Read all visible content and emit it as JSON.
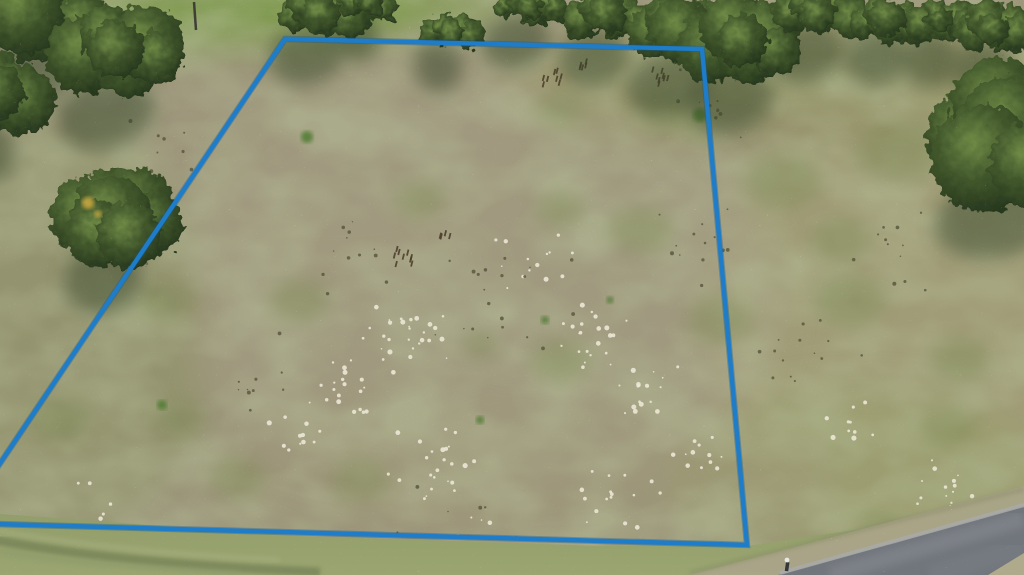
{
  "meta": {
    "title": "Aerial drone photo of a cleared vacant land parcel outlined with a blue property-boundary overlay, tree line along the top, bushes at the edges and a paved road at the lower right",
    "width": 1024,
    "height": 575
  },
  "palette": {
    "ground_base": "#9c957b",
    "boundary_blue": "#1e7cc8",
    "boundary_blue_dark": "#0e5a96",
    "tree_dark": "#20301a",
    "tree_mid": "#42582c",
    "tree_light": "#6f8a46",
    "shadow_olive": "#39462a",
    "lawn_green": "#7e9a4e",
    "verge_green": "#8f9a68",
    "road_gray": "#71757c",
    "road_edge_light": "#a8aaa8",
    "shoulder_tan": "#aaa488",
    "sand_white": "#ece7d6",
    "speck_dark": "#55543c",
    "weed_brown": "#4a3b28",
    "autumn_yellow": "#c9a83f",
    "blotch_olive_rgb": "0.45 0.50 0.30"
  },
  "boundary": {
    "label": "property-boundary",
    "points": "285,39 702,49 747,545 -40,523",
    "stroke_width": 4.4
  },
  "terrain_tints": [
    [
      250,
      12,
      170,
      40,
      "#7e9a4e",
      0.95
    ],
    [
      395,
      6,
      120,
      26,
      "#85a055",
      0.8
    ],
    [
      800,
      70,
      260,
      50,
      "#9da06b",
      0.65
    ],
    [
      620,
      80,
      140,
      45,
      "#a09c72",
      0.5
    ],
    [
      930,
      320,
      230,
      230,
      "#a4a274",
      0.55
    ],
    [
      860,
      480,
      200,
      90,
      "#9aa06c",
      0.5
    ],
    [
      55,
      330,
      160,
      210,
      "#8e9366",
      0.55
    ],
    [
      480,
      300,
      300,
      210,
      "#a59d84",
      0.5
    ],
    [
      340,
      150,
      190,
      120,
      "#a29a7f",
      0.45
    ],
    [
      810,
      115,
      270,
      45,
      "#8e8d62",
      0.4
    ],
    [
      520,
      480,
      320,
      80,
      "#9e9778",
      0.4
    ]
  ],
  "trees": [
    {
      "x": 25,
      "y": 12,
      "rx": 80,
      "ry": 50
    },
    {
      "x": 118,
      "y": 50,
      "rx": 58,
      "ry": 48
    },
    {
      "x": 0,
      "y": 95,
      "rx": 30,
      "ry": 40
    },
    {
      "x": 318,
      "y": 14,
      "rx": 44,
      "ry": 26
    },
    {
      "x": 368,
      "y": 4,
      "rx": 28,
      "ry": 16
    },
    {
      "x": 450,
      "y": 30,
      "rx": 28,
      "ry": 20
    },
    {
      "x": 528,
      "y": 8,
      "rx": 40,
      "ry": 18
    },
    {
      "x": 606,
      "y": 16,
      "rx": 42,
      "ry": 26
    },
    {
      "x": 680,
      "y": 30,
      "rx": 50,
      "ry": 38
    },
    {
      "x": 742,
      "y": 42,
      "rx": 52,
      "ry": 42
    },
    {
      "x": 818,
      "y": 12,
      "rx": 46,
      "ry": 26
    },
    {
      "x": 888,
      "y": 18,
      "rx": 38,
      "ry": 24
    },
    {
      "x": 942,
      "y": 22,
      "rx": 34,
      "ry": 22
    },
    {
      "x": 995,
      "y": 28,
      "rx": 36,
      "ry": 26
    },
    {
      "x": 1012,
      "y": 128,
      "rx": 78,
      "ry": 72,
      "big": true
    },
    {
      "x": 115,
      "y": 213,
      "rx": 46,
      "ry": 50,
      "big": true
    }
  ],
  "autumn_accents": [
    [
      88,
      203,
      6
    ],
    [
      98,
      214,
      3.5
    ]
  ],
  "green_patches": [
    [
      560,
      108,
      24
    ],
    [
      665,
      112,
      28
    ],
    [
      700,
      125,
      16
    ],
    [
      480,
      345,
      18
    ],
    [
      850,
      300,
      36
    ],
    [
      948,
      428,
      28
    ],
    [
      882,
      528,
      24
    ],
    [
      168,
      300,
      30
    ],
    [
      60,
      420,
      32
    ],
    [
      238,
      478,
      28
    ],
    [
      640,
      230,
      32
    ],
    [
      782,
      182,
      38
    ],
    [
      900,
      152,
      42
    ],
    [
      420,
      200,
      26
    ],
    [
      300,
      300,
      30
    ],
    [
      180,
      420,
      26
    ],
    [
      560,
      360,
      30
    ],
    [
      720,
      320,
      34
    ],
    [
      360,
      480,
      30
    ],
    [
      560,
      210,
      24
    ],
    [
      840,
      240,
      30
    ],
    [
      960,
      360,
      30
    ]
  ],
  "bright_tufts": [
    [
      307,
      137,
      6
    ],
    [
      162,
      405,
      5
    ],
    [
      700,
      115,
      7
    ],
    [
      545,
      320,
      4
    ],
    [
      610,
      300,
      3.5
    ],
    [
      480,
      420,
      4
    ]
  ],
  "white_sand_clusters": [
    [
      410,
      335,
      55,
      28
    ],
    [
      350,
      390,
      45,
      20
    ],
    [
      430,
      465,
      55,
      24
    ],
    [
      600,
      340,
      45,
      22
    ],
    [
      640,
      390,
      40,
      18
    ],
    [
      620,
      495,
      50,
      16
    ],
    [
      705,
      455,
      35,
      12
    ],
    [
      950,
      480,
      45,
      14
    ],
    [
      860,
      420,
      35,
      10
    ],
    [
      540,
      260,
      60,
      14
    ],
    [
      300,
      430,
      40,
      12
    ],
    [
      100,
      520,
      60,
      8
    ],
    [
      480,
      550,
      60,
      8
    ]
  ],
  "dark_speck_clusters": [
    [
      500,
      300,
      80,
      20
    ],
    [
      700,
      250,
      60,
      14
    ],
    [
      350,
      250,
      60,
      12
    ],
    [
      800,
      350,
      70,
      14
    ],
    [
      900,
      250,
      60,
      12
    ],
    [
      250,
      380,
      60,
      10
    ],
    [
      150,
      150,
      50,
      8
    ],
    [
      700,
      100,
      50,
      10
    ],
    [
      450,
      520,
      70,
      10
    ]
  ],
  "weed_clusters": [
    [
      402,
      262,
      9,
      16
    ],
    [
      550,
      82,
      8,
      12
    ],
    [
      660,
      82,
      8,
      14
    ],
    [
      445,
      240,
      4,
      8
    ],
    [
      580,
      70,
      5,
      10
    ]
  ],
  "utility_pole": {
    "x": 194,
    "y1": 2,
    "y2": 30
  },
  "verge": {
    "points": "0,514 300,536 600,546 747,546 880,526 1024,490 1024,575 0,575"
  },
  "swale_paths": [
    [
      "M -5,540 C 80,556 180,566 320,572",
      "#646f48",
      9,
      0.5
    ],
    [
      "M -5,530 C 70,544 160,554 280,560",
      "#a9b183",
      5,
      0.5
    ],
    [
      "M -5,551 C 60,562 140,569 240,573",
      "#8c9a6a",
      6,
      0.5
    ]
  ],
  "shoulder": {
    "points": "690,575 1024,486 1024,510 782,575"
  },
  "shoulder_edge": [
    "M 690,573 L 1024,489",
    "#7e815e",
    3,
    0.5
  ],
  "road": {
    "points": "778,575 1024,506 1024,575",
    "streaks": [
      [
        "M 830,575 L 1024,519",
        "#8b9095",
        16,
        0.45
      ],
      [
        "M 930,575 L 1024,548",
        "#7d8187",
        20,
        0.4
      ]
    ],
    "top_edge": [
      "M 780,573 L 1024,505",
      "#a8aaa8",
      4,
      0.85
    ],
    "far_shoulder": "988,575 1024,553 1024,575"
  },
  "mailbox": {
    "x": 786,
    "y": 562
  }
}
